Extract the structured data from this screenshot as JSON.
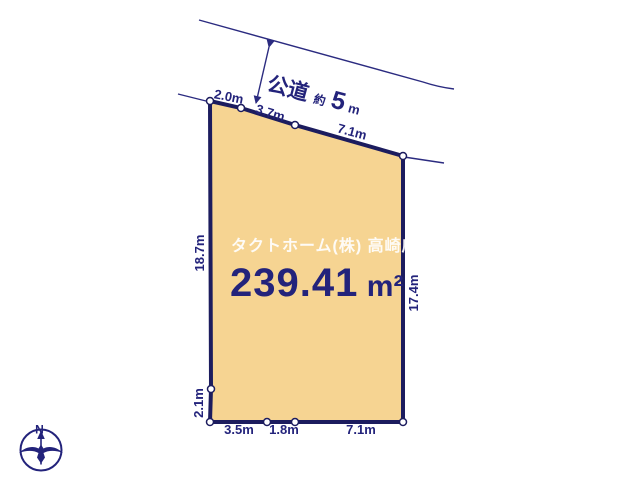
{
  "colors": {
    "line_navy": "#2b2b80",
    "border_navy": "#1c1c5e",
    "text_navy": "#23237b",
    "parcel_fill": "#f6d492",
    "vertex_fill": "#ffffff",
    "watermark_color": "#ffffff",
    "background": "#ffffff"
  },
  "site_plan": {
    "area": {
      "value": "239.41",
      "unit": "m²"
    },
    "watermark": "タクトホーム(株) 高崎店",
    "road": {
      "name": "公道",
      "approx_prefix": "約",
      "width_value": "5",
      "width_unit": "m"
    },
    "compass": {
      "north_label": "N"
    },
    "dimensions": {
      "top": [
        "2.0m",
        "3.7m",
        "7.1m"
      ],
      "left_upper": "18.7m",
      "left_lower": "2.1m",
      "right": "17.4m",
      "bottom": [
        "3.5m",
        "1.8m",
        "7.1m"
      ]
    }
  }
}
